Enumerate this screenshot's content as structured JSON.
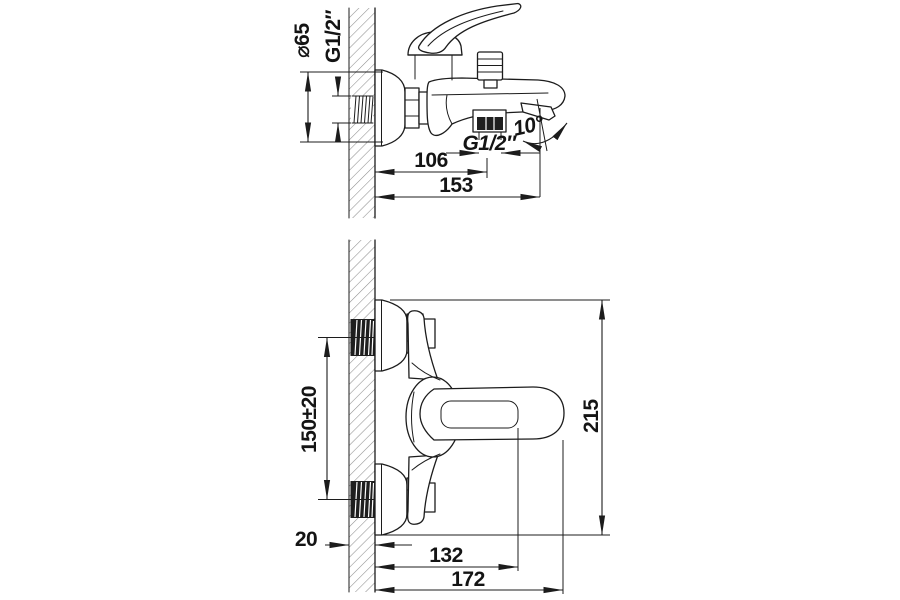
{
  "page": {
    "background": "#ffffff",
    "ink": "#1c1c1c",
    "hatch_color": "#8f8f8f",
    "dark_fill": "#1f1f1f"
  },
  "side_view": {
    "label_escutcheon_diameter": "⌀65",
    "label_wall_thread": "G1/2″",
    "label_outlet_thread": "G1/2″",
    "label_spout_angle": "10°",
    "dim_wall_to_outlet": "106",
    "dim_wall_to_spout_end": "153"
  },
  "plan_view": {
    "dim_inlet_spacing": "150±20",
    "dim_overall_width": "215",
    "dim_wall_thickness": "20",
    "dim_wall_to_outlet_axis": "132",
    "dim_wall_to_handle_end": "172"
  }
}
